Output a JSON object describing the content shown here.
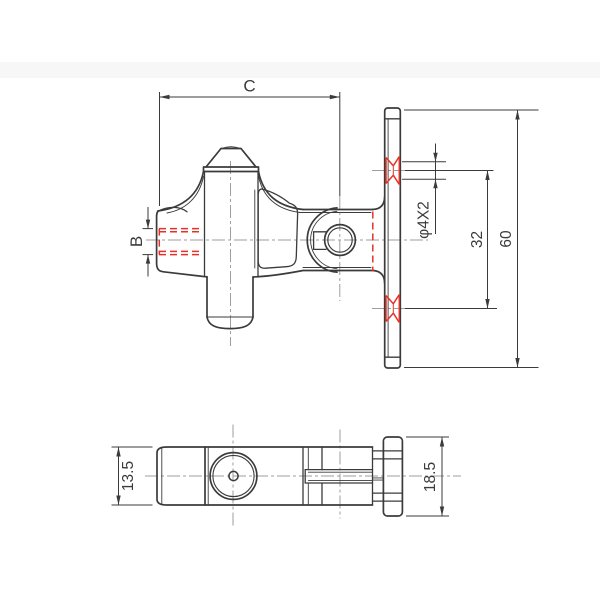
{
  "canvas": {
    "width": 600,
    "height": 600,
    "background": "#ffffff"
  },
  "style": {
    "line_color": "#3b3b3b",
    "highlight_color": "#e53228",
    "centerline_color": "#9e9e9e"
  },
  "front_view": {
    "labels": {
      "overall_width": "C",
      "lug_bore": "B",
      "plate_holes": "φ4X2",
      "hole_spacing": "32",
      "plate_height": "60"
    }
  },
  "top_view": {
    "labels": {
      "body_depth": "13.5",
      "plate_depth": "18.5"
    }
  }
}
